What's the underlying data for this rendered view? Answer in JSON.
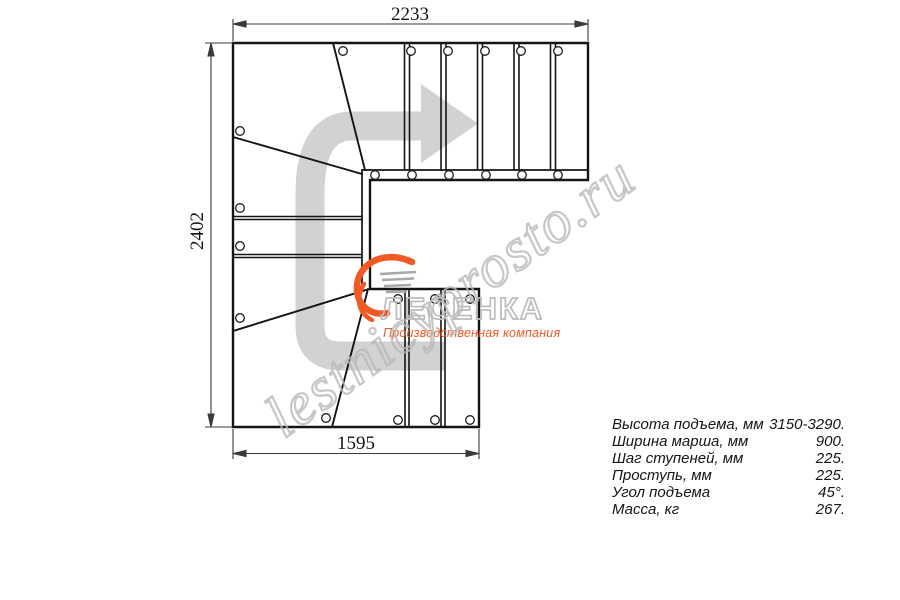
{
  "drawing": {
    "dim_top": "2233",
    "dim_left": "2402",
    "dim_bottom": "1595",
    "line_color": "#141414",
    "arrow_color": "#d2d2d2"
  },
  "watermark": {
    "text": "lestnicyprosto.ru",
    "color": "#b9b9b9"
  },
  "logo": {
    "name": "ЛЕСЕНКА",
    "tagline": "Производственная компания",
    "accent_color": "#f15a24",
    "outline_color": "#bcbcbc"
  },
  "specs": {
    "rows": [
      {
        "label": "Высота подъема, мм",
        "value": "3150-3290."
      },
      {
        "label": "Ширина марша, мм",
        "value": "900."
      },
      {
        "label": "Шаг ступеней, мм",
        "value": "225."
      },
      {
        "label": "Проступь, мм",
        "value": "225."
      },
      {
        "label": "Угол подъема",
        "value": "45°."
      },
      {
        "label": "Масса, кг",
        "value": "267."
      }
    ]
  }
}
